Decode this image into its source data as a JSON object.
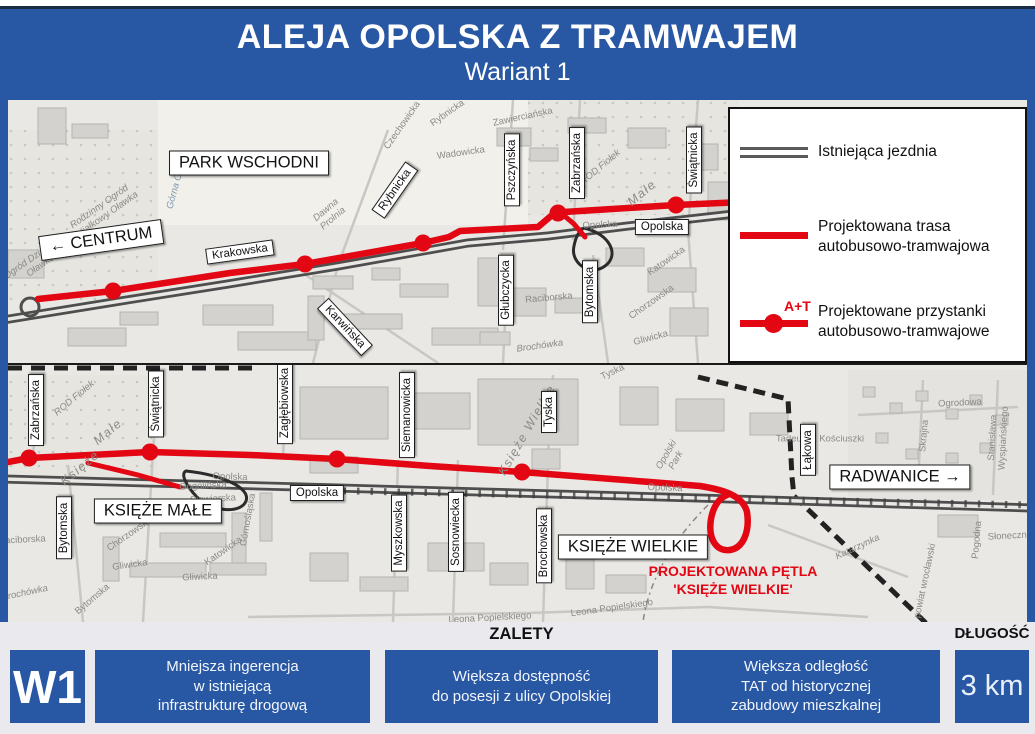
{
  "header": {
    "title": "ALEJA OPOLSKA Z TRAMWAJEM",
    "subtitle": "Wariant 1"
  },
  "legend": {
    "items": [
      {
        "id": "existing-road",
        "label": "Istniejąca jezdnia"
      },
      {
        "id": "planned-route",
        "label": "Projektowana trasa\nautobusowo-tramwajowa"
      },
      {
        "id": "planned-stops",
        "label": "Projektowane przystanki\nautobusowo-tramwajowe",
        "marker_text": "A+T"
      }
    ]
  },
  "map_top": {
    "street_labels": [
      {
        "text": "PARK WSCHODNI",
        "x": 241,
        "y": 63,
        "rot": 0,
        "cls": "street lg"
      },
      {
        "text": "← CENTRUM",
        "x": 93,
        "y": 140,
        "rot": -8,
        "cls": "street lg"
      },
      {
        "text": "Krakowska",
        "x": 232,
        "y": 152,
        "rot": -8,
        "cls": "street"
      },
      {
        "text": "Rybnicka",
        "x": 387,
        "y": 90,
        "rot": -55,
        "cls": "street"
      },
      {
        "text": "Karwińska",
        "x": 337,
        "y": 227,
        "rot": 47,
        "cls": "street"
      },
      {
        "text": "Pszczyńska",
        "x": 504,
        "y": 70,
        "rot": -90,
        "cls": "street"
      },
      {
        "text": "Zabrzańska",
        "x": 569,
        "y": 63,
        "rot": -90,
        "cls": "street"
      },
      {
        "text": "Świątnicka",
        "x": 686,
        "y": 60,
        "rot": -90,
        "cls": "street"
      },
      {
        "text": "Głubczycka",
        "x": 498,
        "y": 190,
        "rot": -90,
        "cls": "street"
      },
      {
        "text": "Bytomska",
        "x": 582,
        "y": 192,
        "rot": -90,
        "cls": "street"
      },
      {
        "text": "Opolska",
        "x": 654,
        "y": 127,
        "rot": 0,
        "cls": "street"
      }
    ],
    "area_labels": [
      {
        "text": "Rodzinny Ogród\nDziałkowy Oławka",
        "x": 95,
        "y": 112,
        "rot": -35,
        "cls": "area it"
      },
      {
        "text": "Ogród Działkowy\nOławka",
        "x": 30,
        "y": 162,
        "rot": -35,
        "cls": "area it"
      },
      {
        "text": "Górna Oława",
        "x": 170,
        "y": 82,
        "rot": -75,
        "cls": "area blue"
      },
      {
        "text": "Dawna\nProlnia",
        "x": 322,
        "y": 115,
        "rot": -40,
        "cls": "area it"
      },
      {
        "text": "Czechowicka",
        "x": 395,
        "y": 26,
        "rot": -55,
        "cls": "area"
      },
      {
        "text": "Rybnicka",
        "x": 440,
        "y": 14,
        "rot": -35,
        "cls": "area"
      },
      {
        "text": "Zawierciańska",
        "x": 515,
        "y": 18,
        "rot": -12,
        "cls": "area"
      },
      {
        "text": "Wadowicka",
        "x": 453,
        "y": 54,
        "rot": -8,
        "cls": "area"
      },
      {
        "text": "ROD Fiołek",
        "x": 593,
        "y": 68,
        "rot": -40,
        "cls": "area it"
      },
      {
        "text": "Małe",
        "x": 634,
        "y": 93,
        "rot": -40,
        "cls": "area it md"
      },
      {
        "text": "Katowicka",
        "x": 659,
        "y": 162,
        "rot": -35,
        "cls": "area"
      },
      {
        "text": "Chorzowska",
        "x": 644,
        "y": 203,
        "rot": -35,
        "cls": "area"
      },
      {
        "text": "Raciborska",
        "x": 541,
        "y": 199,
        "rot": -5,
        "cls": "area"
      },
      {
        "text": "Gliwicka",
        "x": 643,
        "y": 239,
        "rot": -15,
        "cls": "area"
      },
      {
        "text": "Brochówka",
        "x": 532,
        "y": 247,
        "rot": -8,
        "cls": "area it"
      },
      {
        "text": "Opolska",
        "x": 592,
        "y": 126,
        "rot": -3,
        "cls": "area"
      }
    ]
  },
  "map_bottom": {
    "street_labels": [
      {
        "text": "Zabrzańska",
        "x": 28,
        "y": 45,
        "rot": -90,
        "cls": "street"
      },
      {
        "text": "Świątnicka",
        "x": 148,
        "y": 39,
        "rot": -90,
        "cls": "street"
      },
      {
        "text": "Zagłębiowska",
        "x": 277,
        "y": 38,
        "rot": -90,
        "cls": "street"
      },
      {
        "text": "Bytomska",
        "x": 56,
        "y": 163,
        "rot": -90,
        "cls": "street"
      },
      {
        "text": "KSIĘŻE MAŁE",
        "x": 150,
        "y": 146,
        "rot": 0,
        "cls": "street lg"
      },
      {
        "text": "Opolska",
        "x": 309,
        "y": 128,
        "rot": 0,
        "cls": "street"
      },
      {
        "text": "Siemanowicka",
        "x": 399,
        "y": 50,
        "rot": -90,
        "cls": "street"
      },
      {
        "text": "Tyska",
        "x": 541,
        "y": 47,
        "rot": -90,
        "cls": "street"
      },
      {
        "text": "Myszkowska",
        "x": 391,
        "y": 168,
        "rot": -90,
        "cls": "street"
      },
      {
        "text": "Sosnowiecka",
        "x": 448,
        "y": 167,
        "rot": -90,
        "cls": "street"
      },
      {
        "text": "Brochowska",
        "x": 536,
        "y": 181,
        "rot": -90,
        "cls": "street"
      },
      {
        "text": "KSIĘŻE WIELKIE",
        "x": 625,
        "y": 182,
        "rot": 0,
        "cls": "street lg"
      },
      {
        "text": "Łąkowa",
        "x": 800,
        "y": 85,
        "rot": -90,
        "cls": "street"
      },
      {
        "text": "RADWANICE →",
        "x": 892,
        "y": 112,
        "rot": 0,
        "cls": "street lg"
      }
    ],
    "area_labels": [
      {
        "text": "ROD Fiołek",
        "x": 67,
        "y": 34,
        "rot": -40,
        "cls": "area it"
      },
      {
        "text": "Małe",
        "x": 100,
        "y": 67,
        "rot": -40,
        "cls": "area it md"
      },
      {
        "text": "Księże",
        "x": 72,
        "y": 103,
        "rot": -40,
        "cls": "area it md"
      },
      {
        "text": "Opolska",
        "x": 222,
        "y": 113,
        "rot": 2,
        "cls": "area"
      },
      {
        "text": "Opolska",
        "x": 657,
        "y": 124,
        "rot": 2,
        "cls": "area"
      },
      {
        "text": "Gogolińska",
        "x": 195,
        "y": 122,
        "rot": -3,
        "cls": "area"
      },
      {
        "text": "Siewierska",
        "x": 205,
        "y": 135,
        "rot": -3,
        "cls": "area"
      },
      {
        "text": "Chorzowska",
        "x": 122,
        "y": 170,
        "rot": -35,
        "cls": "area"
      },
      {
        "text": "Katowicka",
        "x": 216,
        "y": 187,
        "rot": -35,
        "cls": "area"
      },
      {
        "text": "Górnośląska",
        "x": 241,
        "y": 155,
        "rot": -80,
        "cls": "area"
      },
      {
        "text": "Gliwicka",
        "x": 122,
        "y": 201,
        "rot": -8,
        "cls": "area"
      },
      {
        "text": "Gliwicka",
        "x": 192,
        "y": 213,
        "rot": -3,
        "cls": "area"
      },
      {
        "text": "Raciborska",
        "x": 14,
        "y": 176,
        "rot": -3,
        "cls": "area"
      },
      {
        "text": "Brochówka",
        "x": 17,
        "y": 229,
        "rot": -12,
        "cls": "area it"
      },
      {
        "text": "Bytomska",
        "x": 85,
        "y": 235,
        "rot": -40,
        "cls": "area"
      },
      {
        "text": "Księże Wielkie",
        "x": 519,
        "y": 65,
        "rot": -60,
        "cls": "area it md"
      },
      {
        "text": "Tyska",
        "x": 605,
        "y": 8,
        "rot": -25,
        "cls": "area"
      },
      {
        "text": "Opolski\nPark",
        "x": 664,
        "y": 93,
        "rot": -60,
        "cls": "area it"
      },
      {
        "text": "Tadeusza Kościuszki",
        "x": 812,
        "y": 75,
        "rot": 0,
        "cls": "area"
      },
      {
        "text": "Ogrodowa",
        "x": 952,
        "y": 39,
        "rot": -3,
        "cls": "area"
      },
      {
        "text": "Skrajna",
        "x": 917,
        "y": 71,
        "rot": -85,
        "cls": "area"
      },
      {
        "text": "Stanisława Wyspiańskiego",
        "x": 991,
        "y": 73,
        "rot": -87,
        "cls": "area"
      },
      {
        "text": "Katarzynka",
        "x": 850,
        "y": 183,
        "rot": -25,
        "cls": "area it"
      },
      {
        "text": "powiat wrocławski",
        "x": 918,
        "y": 216,
        "rot": -78,
        "cls": "area"
      },
      {
        "text": "Pogodna",
        "x": 970,
        "y": 175,
        "rot": -85,
        "cls": "area"
      },
      {
        "text": "Słoneczna",
        "x": 1002,
        "y": 172,
        "rot": -3,
        "cls": "area"
      },
      {
        "text": "Leona Popielskiego",
        "x": 482,
        "y": 254,
        "rot": -3,
        "cls": "area"
      },
      {
        "text": "Leona Popielskiego",
        "x": 604,
        "y": 244,
        "rot": -8,
        "cls": "area"
      }
    ],
    "loop_caption": "PROJEKTOWANA PĘTLA\n'KSIĘŻE WIELKIE'"
  },
  "footer": {
    "advantages_heading": "ZALETY",
    "length_heading": "DŁUGOŚĆ",
    "variant_label": "W1",
    "advantages": [
      "Mniejsza ingerencja\nw istniejącą\ninfrastrukturę drogową",
      "Większa dostępność\ndo posesji z ulicy Opolskiej",
      "Większa odległość\nTAT od historycznej\nzabudowy mieszkalnej"
    ],
    "length_value": "3 km"
  },
  "colors": {
    "blue": "#2857a4",
    "red": "#e30613",
    "road": "#4e4e4e"
  }
}
